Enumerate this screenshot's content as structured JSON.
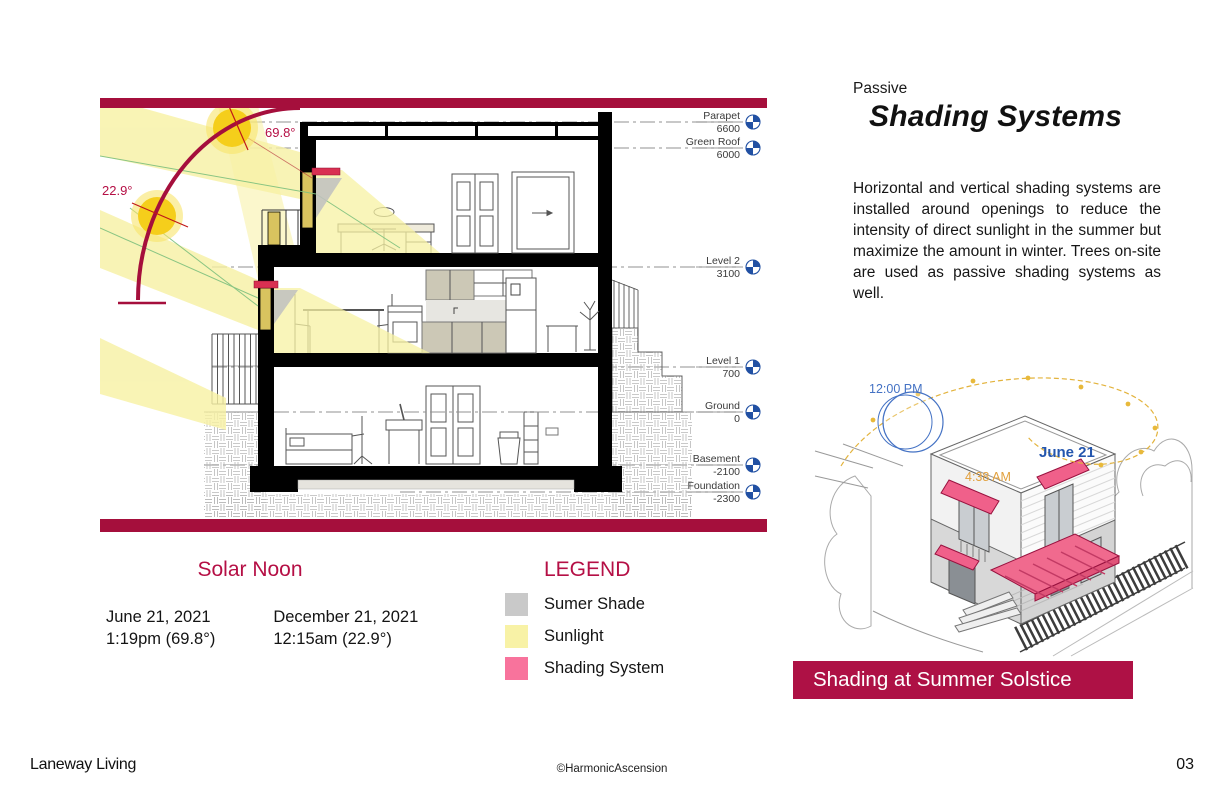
{
  "right_panel": {
    "eyebrow": "Passive",
    "title": "Shading Systems",
    "body": "Horizontal and vertical shading systems are installed around openings to reduce the intensity of direct sunlight in the summer but maximize the amount in winter. Trees on-site are used as passive shading systems as well.",
    "iso_labels": {
      "noon": "12:00 PM",
      "date": "June 21",
      "sunrise": "4:38 AM"
    },
    "banner": "Shading at Summer Solstice"
  },
  "solar_noon": {
    "title": "Solar Noon",
    "columns": [
      {
        "date": "June 21, 2021",
        "time": "1:19pm (69.8°)"
      },
      {
        "date": "December 21, 2021",
        "time": "12:15am (22.9°)"
      }
    ]
  },
  "legend": {
    "title": "LEGEND",
    "items": [
      {
        "label": "Sumer Shade",
        "color": "#C9C9C9"
      },
      {
        "label": "Sunlight",
        "color": "#F8F2A6"
      },
      {
        "label": "Shading System",
        "color": "#F8739C"
      }
    ]
  },
  "section": {
    "angles": {
      "summer": "69.8°",
      "winter": "22.9°"
    },
    "levels": [
      {
        "name": "Parapet",
        "value": "6600"
      },
      {
        "name": "Green Roof",
        "value": "6000"
      },
      {
        "name": "Level 2",
        "value": "3100"
      },
      {
        "name": "Level 1",
        "value": "700"
      },
      {
        "name": "Ground",
        "value": "0"
      },
      {
        "name": "Basement",
        "value": "-2100"
      },
      {
        "name": "Foundation",
        "value": "-2300"
      }
    ]
  },
  "footer": {
    "left": "Laneway Living",
    "center": "©HarmonicAscension",
    "right": "03"
  },
  "colors": {
    "accent_crimson": "#A50F3C",
    "heading_crimson": "#B50F45",
    "banner_crimson": "#AE1145",
    "sunlight_yellow": "#F7F1A3",
    "sun_core": "#F5CE1B",
    "shade_gray": "#C9C9C9",
    "shading_pink": "#F2618C",
    "datum_blue": "#2150A3",
    "iso_label_blue": "#4472C4",
    "iso_date_blue": "#2456AE",
    "iso_time_orange": "#E2A03C"
  }
}
